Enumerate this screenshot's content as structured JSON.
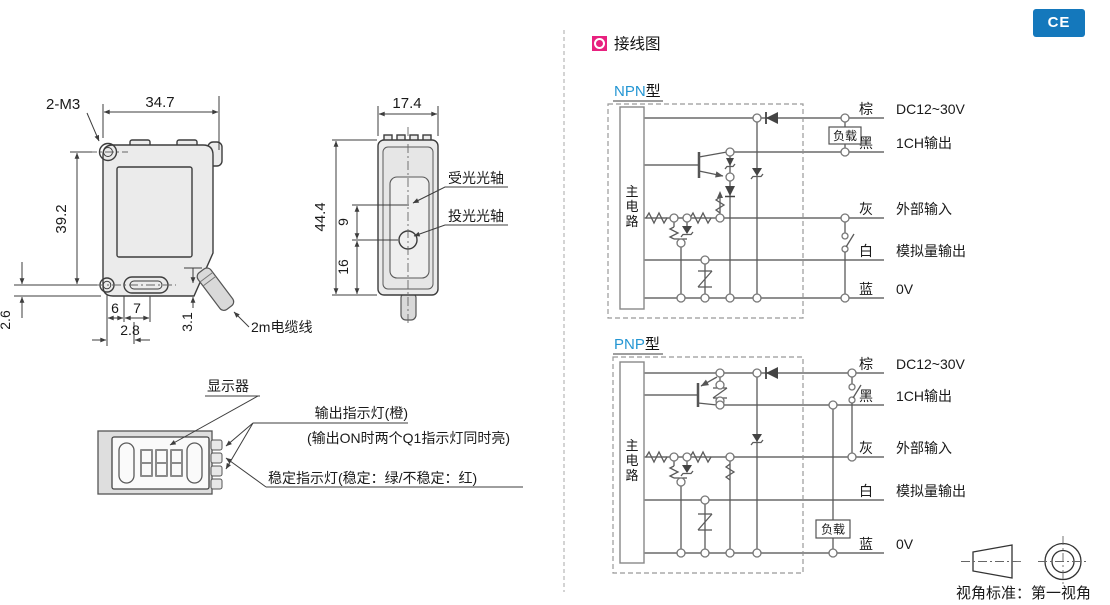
{
  "ce_badge": "CE",
  "section_title": "接线图",
  "front_view": {
    "thread_label": "2-M3",
    "dim_width": "34.7",
    "dim_height": "39.2",
    "dim_hole_offset": "2.6",
    "dim_slot_gap": "6",
    "dim_slot_len": "7",
    "dim_hole_to_slot": "2.8",
    "dim_step": "3.1",
    "cable_label": "2m电缆线"
  },
  "side_view": {
    "dim_width": "17.4",
    "dim_height": "44.4",
    "dim_axis_gap": "9",
    "dim_emit_height": "16",
    "receive_axis_label": "受光光轴",
    "emit_axis_label": "投光光轴"
  },
  "display_view": {
    "display_label": "显示器",
    "output_led_label": "输出指示灯(橙)",
    "output_led_note": "(输出ON时两个Q1指示灯同时亮)",
    "stability_led_label": "稳定指示灯(稳定：绿/不稳定：红)"
  },
  "wiring": {
    "npn_type": "NPN",
    "pnp_type": "PNP",
    "type_suffix": "型",
    "main_circuit_chars": [
      "主",
      "电",
      "路"
    ],
    "load_label": "负载",
    "wires": [
      {
        "color": "棕",
        "signal": "DC12~30V"
      },
      {
        "color": "黑",
        "signal": "1CH输出"
      },
      {
        "color": "灰",
        "signal": "外部输入"
      },
      {
        "color": "白",
        "signal": "模拟量输出"
      },
      {
        "color": "蓝",
        "signal": "0V"
      }
    ]
  },
  "projection_note": "视角标准：第一视角",
  "colors": {
    "accent_blue": "#2496d3",
    "badge_blue": "#1478bc",
    "accent_magenta": "#e8217f",
    "wire_gray": "#8f8f8f",
    "line_dark": "#3d3d3d",
    "body_fill": "#ebebeb"
  }
}
